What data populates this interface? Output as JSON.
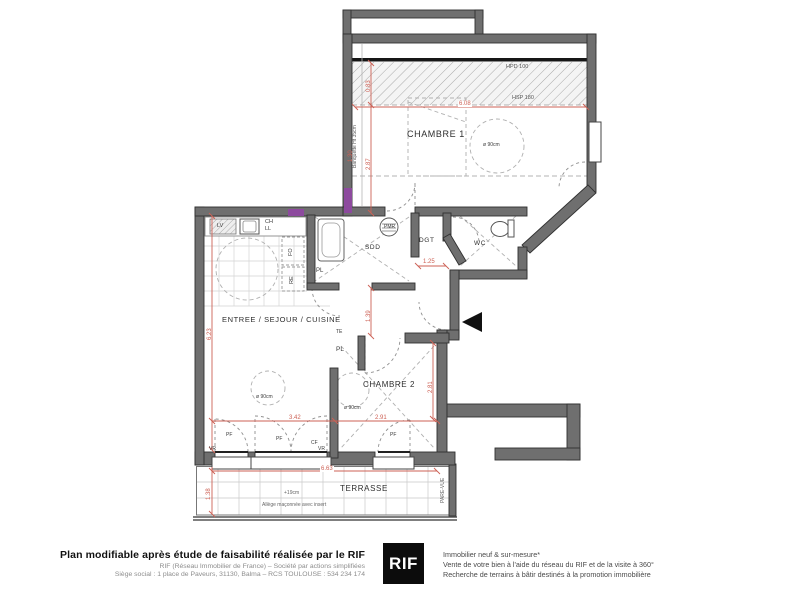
{
  "colors": {
    "wall": "#6f6f6f",
    "dimension_red": "#cd6155",
    "accent_purple": "#8d4a9e",
    "ink": "#3a3a3a"
  },
  "plan": {
    "rooms": {
      "chambre1": "CHAMBRE 1",
      "chambre2": "CHAMBRE 2",
      "sejour": "ENTREE / SEJOUR / CUISINE",
      "sdd": "SDD",
      "dgt": "DGT",
      "wc": "WC",
      "terrasse": "TERRASSE"
    },
    "fixtures": {
      "pl": "PL",
      "te": "TE",
      "ch": "CH",
      "ll": "LL",
      "lv": "LV",
      "fo": "FO",
      "re": "RE",
      "pmr": "PMR",
      "pf": "PF",
      "cf": "CF",
      "vr": "VR"
    },
    "annotations": {
      "hpd": "HPD 100",
      "hsp": "HSP 180",
      "banquette": "Banquette Ht 35cm",
      "circle_diameter": "ø 90cm",
      "terrace_level": "+19cm",
      "allege": "Allège maçonnée avec insert",
      "pare_vue": "PARE-VUE"
    },
    "dimensions": {
      "chambre1_width": "6.08",
      "hpd_depth": "0.83",
      "chambre1_depth": "2.87",
      "banquette_depth": "1.30",
      "sejour_height": "6.23",
      "passage": "1.39",
      "dgt_width": "1.25",
      "sejour_width": "3.42",
      "chambre2_width": "2.91",
      "chambre2_depth": "2.81",
      "terrasse_width": "6.63",
      "terrasse_depth": "1.38"
    }
  },
  "footer": {
    "title": "Plan modifiable après étude de faisabilité réalisée par le RIF",
    "company_line1": "RIF (Réseau Immobilier de France) – Société par actions simplifiées",
    "company_line2": "Siège social : 1 place de Paveurs, 31130, Balma – RCS TOULOUSE : 534 234 174",
    "logo": "RIF",
    "tagline1": "Immobilier neuf & sur-mesure*",
    "tagline2": "Vente de votre bien à l'aide du réseau du RIF et de la visite à 360°",
    "tagline3": "Recherche de terrains à bâtir destinés à la promotion immobilière"
  }
}
